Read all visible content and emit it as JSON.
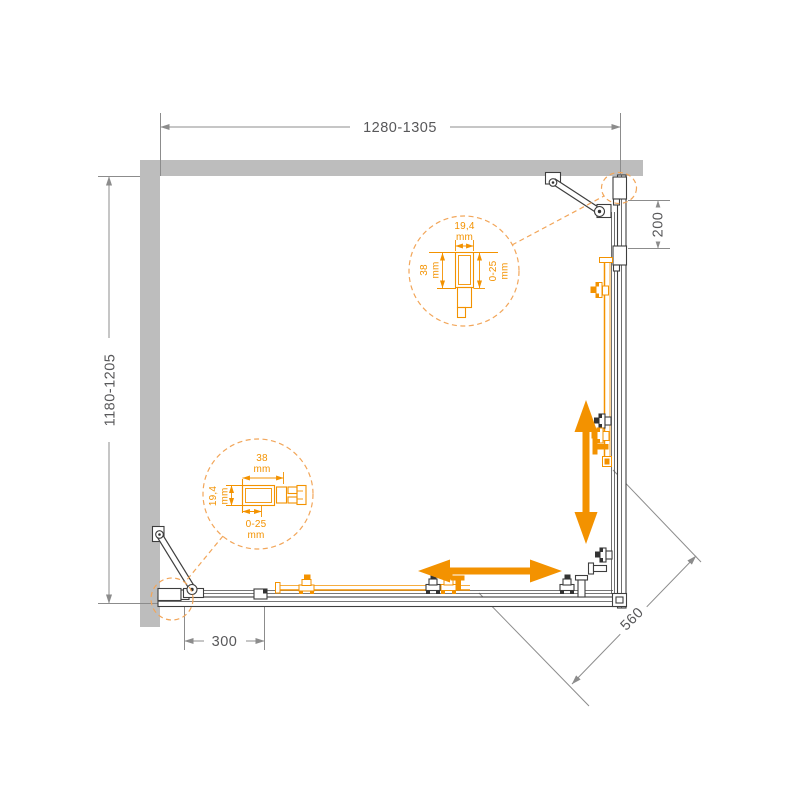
{
  "diagram": {
    "dims": {
      "top_width": "1280-1305",
      "left_depth": "1180-1205",
      "right_offset": "200",
      "bottom_offset": "300",
      "entry_width": "560"
    },
    "detail_top": {
      "profile_width": "19,4",
      "profile_width_unit": "mm",
      "profile_depth": "38",
      "profile_depth_unit": "mm",
      "adjust_range": "0-25",
      "adjust_range_unit": "mm"
    },
    "detail_bottom": {
      "profile_width": "38",
      "profile_width_unit": "mm",
      "profile_depth": "19,4",
      "profile_depth_unit": "mm",
      "adjust_range": "0-25",
      "adjust_range_unit": "mm"
    },
    "colors": {
      "accent_orange": "#F39200",
      "accent_orange_light": "#F2A65A",
      "wall_gray": "#BDBDBD",
      "line_dark": "#3E3E3E",
      "dim_gray": "#8C8C8C",
      "text_gray": "#58585A"
    }
  }
}
